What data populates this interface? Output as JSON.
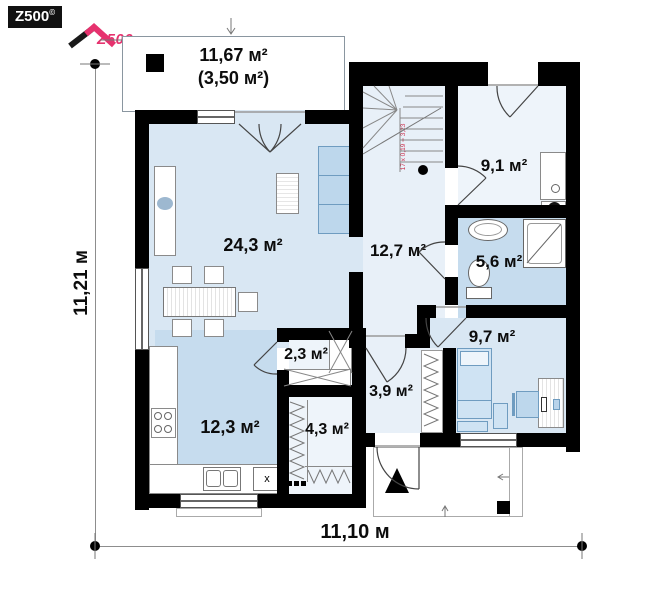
{
  "branding": {
    "badge_text": "Z500",
    "badge_sup": "©",
    "logo_text": "Z500"
  },
  "plan": {
    "terrace": {
      "area": "11,67 м²",
      "area_alt": "(3,50 м²)"
    },
    "rooms": {
      "living": {
        "area": "24,3 м²"
      },
      "hall": {
        "area": "12,7 м²"
      },
      "kitchen": {
        "area": "12,3 м²"
      },
      "utility": {
        "area": "9,1 м²"
      },
      "bathroom": {
        "area": "5,6 м²"
      },
      "bedroom": {
        "area": "9,7 м²"
      },
      "pantry": {
        "area": "2,3 м²"
      },
      "entry": {
        "area": "3,9 м²"
      },
      "wardrobe": {
        "area": "4,3 м²"
      }
    },
    "stairs": {
      "annotation": "17 x 0,19 = 3,23"
    },
    "kitchen_appliance_mark": "x",
    "dimensions": {
      "width": "11,10 м",
      "height": "11,21 м"
    }
  },
  "colors": {
    "wall": "#000000",
    "floor_light": "#d9e7f3",
    "floor_medium": "#c6dcee",
    "floor_pale": "#e8f0f8",
    "accent_pink": "#e6326e",
    "stair_note_red": "#cf3350"
  }
}
